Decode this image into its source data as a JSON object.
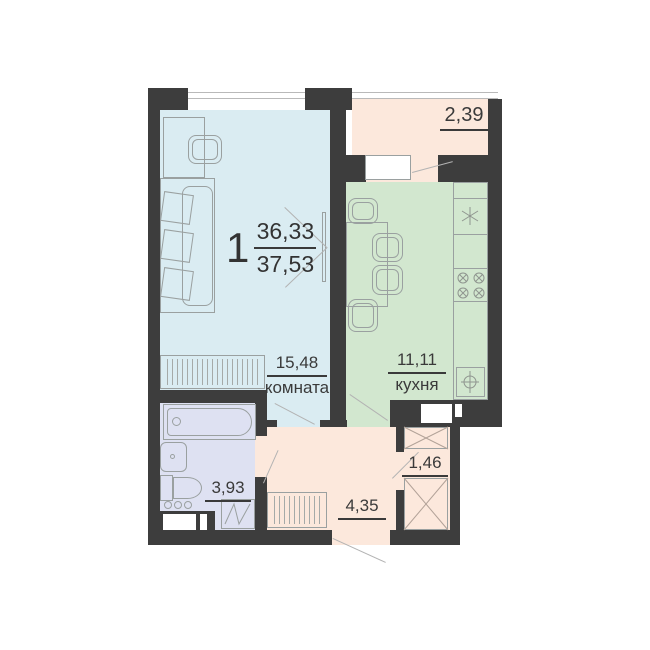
{
  "plan": {
    "type_number": "1",
    "living_area": "36,33",
    "total_area": "37,53",
    "rooms": {
      "living": {
        "name": "комната",
        "area": "15,48"
      },
      "kitchen": {
        "name": "кухня",
        "area": "11,11"
      },
      "bathroom": {
        "area": "3,93"
      },
      "hallway": {
        "area": "4,35"
      },
      "storage": {
        "area": "1,46"
      },
      "balcony": {
        "area": "2,39"
      }
    },
    "colors": {
      "wall": "#3d3d3d",
      "living_room": "#daecf2",
      "kitchen": "#d2e7cf",
      "bathroom": "#dee1f2",
      "hallway_balcony": "#fce8dc",
      "label_text": "#3a3a3a"
    },
    "icons": {
      "fridge": "snowflake-asterisk",
      "stove": "four-crossed-burners",
      "sink": "circle-cross",
      "duct_shaft": "crossed-box"
    }
  }
}
